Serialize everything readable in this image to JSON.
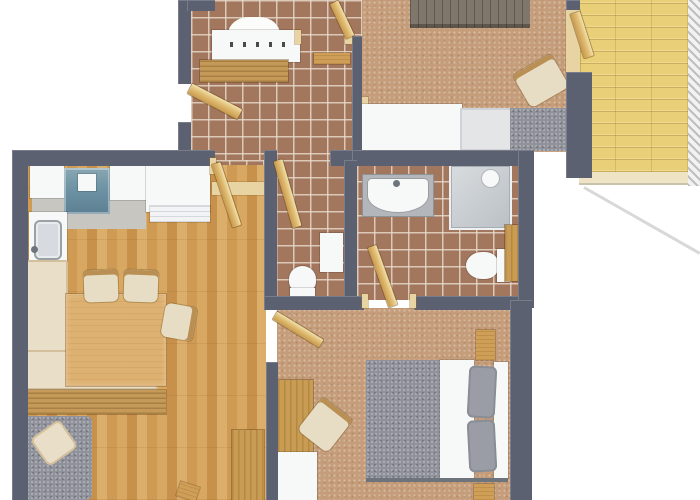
{
  "meta": {
    "kind": "apartment-floor-plan-3d-top-view",
    "canvas": {
      "width": 700,
      "height": 500,
      "background": "#ffffff"
    }
  },
  "palette": {
    "wall": "#5b6170",
    "tile": "#a3765e",
    "carpet": "#c59d7a",
    "wood_floor": "#d2a05b",
    "balcony_wood": "#e9cf78",
    "furniture_wood": "#cf9f58",
    "door_wood": "#e2bf76",
    "white": "#f7f8f8",
    "gray_fabric": "#8f929a",
    "cream": "#e9dfc8",
    "teal": "#6d93a4",
    "steel": "#d7dbdf",
    "dark_dresser": "#7f776b"
  },
  "rooms": [
    {
      "name": "entrance-hall",
      "floor": "tile"
    },
    {
      "name": "bedroom-top",
      "floor": "carpet"
    },
    {
      "name": "balcony",
      "floor": "wood-deck"
    },
    {
      "name": "kitchen-living-dining",
      "floor": "wood"
    },
    {
      "name": "wc",
      "floor": "tile"
    },
    {
      "name": "bathroom",
      "floor": "tile"
    },
    {
      "name": "bedroom-master",
      "floor": "carpet"
    }
  ],
  "items": [
    {
      "n": "hall-tile-floor",
      "c": "tile",
      "x": 191,
      "y": 0,
      "w": 171,
      "h": 166
    },
    {
      "n": "corridor-tile-floor",
      "c": "tile",
      "x": 212,
      "y": 160,
      "w": 52,
      "h": 36
    },
    {
      "n": "wc-tile-floor",
      "c": "tile",
      "x": 276,
      "y": 160,
      "w": 68,
      "h": 140
    },
    {
      "n": "bathroom-tile-floor",
      "c": "tile",
      "x": 357,
      "y": 164,
      "w": 161,
      "h": 136
    },
    {
      "n": "bedroom2-carpet",
      "c": "carpet",
      "x": 362,
      "y": 0,
      "w": 204,
      "h": 152
    },
    {
      "n": "bedroom1-carpet",
      "c": "carpet",
      "x": 277,
      "y": 308,
      "w": 235,
      "h": 192
    },
    {
      "n": "living-wood-floor",
      "c": "woodfloor",
      "x": 27,
      "y": 165,
      "w": 239,
      "h": 335
    },
    {
      "n": "balcony-deck",
      "c": "balcony",
      "x": 579,
      "y": 0,
      "w": 111,
      "h": 172
    },
    {
      "n": "balcony-edge",
      "c": "balc-edge",
      "x": 579,
      "y": 172,
      "w": 109,
      "h": 13
    },
    {
      "n": "balcony-railing",
      "c": "hatch",
      "x": 688,
      "y": 0,
      "w": 12,
      "h": 186
    },
    {
      "n": "balcony-shadow-edge",
      "c": "shadowline",
      "x1": 584,
      "y1": 187,
      "x2": 700,
      "y2": 253,
      "t": 3
    },
    {
      "n": "kitchen-floor",
      "c": "grayfloor",
      "x": 32,
      "y": 196,
      "w": 114,
      "h": 33
    },
    {
      "n": "floor-transition",
      "c": "wood-light",
      "x": 212,
      "y": 182,
      "w": 52,
      "h": 13
    },
    {
      "n": "balcony-threshold",
      "c": "wood-light",
      "x": 566,
      "y": 10,
      "w": 14,
      "h": 62
    },
    {
      "n": "decor-arch",
      "c": "arch",
      "x": 228,
      "y": 17,
      "w": 52,
      "h": 22
    },
    {
      "n": "coat-rack-panel",
      "c": "white",
      "x": 212,
      "y": 30,
      "w": 88,
      "h": 32
    },
    {
      "n": "coat-hooks",
      "c": "hooks",
      "x": 230,
      "y": 42,
      "w": 60,
      "h": 5
    },
    {
      "n": "hall-bench",
      "c": "wood-striped",
      "x": 200,
      "y": 60,
      "w": 88,
      "h": 22
    },
    {
      "n": "hall-wall-shelf",
      "c": "wood",
      "x": 314,
      "y": 53,
      "w": 36,
      "h": 11
    },
    {
      "n": "bedroom2-door-sill",
      "c": "wood-light",
      "x": 352,
      "y": 97,
      "w": 16,
      "h": 13
    },
    {
      "n": "kitchen-counter-left",
      "c": "white",
      "x": 30,
      "y": 166,
      "w": 34,
      "h": 32
    },
    {
      "n": "cooktop",
      "c": "teal",
      "x": 64,
      "y": 168,
      "w": 46,
      "h": 46
    },
    {
      "n": "cooktop-pot",
      "c": "white",
      "x": 78,
      "y": 174,
      "w": 18,
      "h": 17
    },
    {
      "n": "kitchen-counter-mid",
      "c": "white",
      "x": 110,
      "y": 166,
      "w": 36,
      "h": 34
    },
    {
      "n": "kitchen-counter-right",
      "c": "white",
      "x": 146,
      "y": 166,
      "w": 64,
      "h": 46
    },
    {
      "n": "kitchen-cabinet-front",
      "c": "shelf-lines",
      "x": 150,
      "y": 206,
      "w": 60,
      "h": 16
    },
    {
      "n": "sink-counter",
      "c": "white",
      "x": 29,
      "y": 212,
      "w": 38,
      "h": 74
    },
    {
      "n": "kitchen-sink",
      "c": "steel",
      "x": 34,
      "y": 220,
      "w": 28,
      "h": 40
    },
    {
      "n": "sink-faucet",
      "c": "metal",
      "x": 31,
      "y": 246,
      "w": 7,
      "h": 7,
      "rad": "50%"
    },
    {
      "n": "sink-drainboard",
      "c": "ridges",
      "x": 34,
      "y": 262,
      "w": 28,
      "h": 21
    },
    {
      "n": "corner-bench-left",
      "c": "cream",
      "x": 24,
      "y": 260,
      "w": 44,
      "h": 130
    },
    {
      "n": "corner-bench-bottom",
      "c": "cream",
      "x": 24,
      "y": 350,
      "w": 134,
      "h": 40
    },
    {
      "n": "bench-wood-frame",
      "c": "wood-striped",
      "x": 28,
      "y": 390,
      "w": 138,
      "h": 24
    },
    {
      "n": "dining-table",
      "c": "wood-table",
      "x": 66,
      "y": 294,
      "w": 100,
      "h": 92
    },
    {
      "n": "dining-chair-1",
      "c": "chair",
      "x": 84,
      "y": 270,
      "w": 34,
      "h": 32,
      "r": -2
    },
    {
      "n": "dining-chair-2",
      "c": "chair",
      "x": 124,
      "y": 270,
      "w": 34,
      "h": 32,
      "r": 2
    },
    {
      "n": "dining-chair-3",
      "c": "chair",
      "x": 162,
      "y": 306,
      "w": 34,
      "h": 32,
      "r": 100
    },
    {
      "n": "sofa",
      "c": "grayfab",
      "x": 18,
      "y": 416,
      "w": 74,
      "h": 84,
      "rad": "6px"
    },
    {
      "n": "sofa-pillow",
      "c": "cream",
      "x": 36,
      "y": 426,
      "w": 36,
      "h": 34,
      "r": -35,
      "rad": "6px"
    },
    {
      "n": "living-cabinet",
      "c": "woodv",
      "x": 232,
      "y": 430,
      "w": 32,
      "h": 70
    },
    {
      "n": "stool",
      "c": "wood",
      "x": 178,
      "y": 484,
      "w": 20,
      "h": 15,
      "r": 18
    },
    {
      "n": "wc-toilet-bowl",
      "c": "white",
      "x": 289,
      "y": 266,
      "w": 27,
      "h": 26,
      "rad": "50% 50% 40% 40%"
    },
    {
      "n": "wc-toilet-tank",
      "c": "white",
      "x": 290,
      "y": 288,
      "w": 25,
      "h": 9
    },
    {
      "n": "wc-wall-cabinet",
      "c": "white",
      "x": 320,
      "y": 233,
      "w": 23,
      "h": 39
    },
    {
      "n": "vanity-counter",
      "c": "graycounter",
      "x": 363,
      "y": 175,
      "w": 70,
      "h": 41
    },
    {
      "n": "bathroom-sink",
      "c": "white",
      "x": 368,
      "y": 179,
      "w": 60,
      "h": 33,
      "rad": "4px 4px 50% 50%"
    },
    {
      "n": "sink-tap",
      "c": "metal",
      "x": 393,
      "y": 180,
      "w": 7,
      "h": 7,
      "rad": "50%"
    },
    {
      "n": "shower",
      "c": "shower",
      "x": 449,
      "y": 164,
      "w": 63,
      "h": 66
    },
    {
      "n": "shower-head",
      "c": "white",
      "x": 482,
      "y": 170,
      "w": 17,
      "h": 17,
      "rad": "50%"
    },
    {
      "n": "bath-toilet-bowl",
      "c": "white",
      "x": 466,
      "y": 252,
      "w": 32,
      "h": 27,
      "rad": "50% 40% 40% 50%"
    },
    {
      "n": "bath-toilet-tank",
      "c": "white",
      "x": 497,
      "y": 249,
      "w": 13,
      "h": 33
    },
    {
      "n": "bath-shelf",
      "c": "woodv",
      "x": 505,
      "y": 225,
      "w": 16,
      "h": 56
    },
    {
      "n": "bedroom2-dresser",
      "c": "dark-dresser",
      "x": 410,
      "y": 0,
      "w": 120,
      "h": 28
    },
    {
      "n": "bedroom2-chair",
      "c": "chair",
      "x": 519,
      "y": 62,
      "w": 44,
      "h": 38,
      "r": -30
    },
    {
      "n": "bedroom2-bed-duvet",
      "c": "white",
      "x": 362,
      "y": 104,
      "w": 100,
      "h": 47
    },
    {
      "n": "bedroom2-bed-pillow",
      "c": "pillow-light",
      "x": 460,
      "y": 108,
      "w": 52,
      "h": 43
    },
    {
      "n": "bedroom2-bed-blanket",
      "c": "grayfab",
      "x": 510,
      "y": 108,
      "w": 62,
      "h": 43
    },
    {
      "n": "bed-duvet",
      "c": "grayfab",
      "x": 366,
      "y": 360,
      "w": 74,
      "h": 120
    },
    {
      "n": "bed-sheet",
      "c": "white",
      "x": 440,
      "y": 360,
      "w": 34,
      "h": 120
    },
    {
      "n": "bed-headboard",
      "c": "white",
      "x": 494,
      "y": 362,
      "w": 14,
      "h": 116
    },
    {
      "n": "bed-pillow-top",
      "c": "pillow-gray",
      "x": 468,
      "y": 366,
      "w": 28,
      "h": 52,
      "r": 3,
      "rad": "6px"
    },
    {
      "n": "bed-pillow-bottom",
      "c": "pillow-gray",
      "x": 468,
      "y": 420,
      "w": 28,
      "h": 52,
      "r": -3,
      "rad": "6px"
    },
    {
      "n": "bed-footboard",
      "c": "metal",
      "x": 366,
      "y": 478,
      "w": 142,
      "h": 4
    },
    {
      "n": "nightstand",
      "c": "wood",
      "x": 476,
      "y": 330,
      "w": 19,
      "h": 30
    },
    {
      "n": "bedroom1-wardrobe",
      "c": "woodv",
      "x": 278,
      "y": 380,
      "w": 35,
      "h": 74
    },
    {
      "n": "bedroom1-chair",
      "c": "chair",
      "x": 306,
      "y": 404,
      "w": 38,
      "h": 42,
      "r": 38
    },
    {
      "n": "bedroom1-desk",
      "c": "white",
      "x": 267,
      "y": 452,
      "w": 50,
      "h": 48
    },
    {
      "n": "bedroom1-side-table",
      "c": "wood",
      "x": 474,
      "y": 484,
      "w": 20,
      "h": 16
    },
    {
      "n": "wall-hall-left-upper",
      "c": "wall",
      "x": 178,
      "y": 0,
      "w": 13,
      "h": 84
    },
    {
      "n": "wall-hall-left-lower",
      "c": "wall",
      "x": 178,
      "y": 122,
      "w": 13,
      "h": 36
    },
    {
      "n": "wall-top-stub",
      "c": "wall",
      "x": 187,
      "y": 0,
      "w": 28,
      "h": 11
    },
    {
      "n": "wall-kitchen-top",
      "c": "wall",
      "x": 12,
      "y": 150,
      "w": 203,
      "h": 16
    },
    {
      "n": "wall-left-outer",
      "c": "wall",
      "x": 12,
      "y": 150,
      "w": 16,
      "h": 350
    },
    {
      "n": "wall-wc-pier",
      "c": "wall",
      "x": 330,
      "y": 150,
      "w": 36,
      "h": 16
    },
    {
      "n": "wall-hall-bedroom2",
      "c": "wall",
      "x": 352,
      "y": 36,
      "w": 10,
      "h": 116
    },
    {
      "n": "wall-bathroom-top",
      "c": "wall",
      "x": 352,
      "y": 150,
      "w": 166,
      "h": 16
    },
    {
      "n": "wall-bathroom-right",
      "c": "wall",
      "x": 518,
      "y": 150,
      "w": 16,
      "h": 158
    },
    {
      "n": "wall-wc-left",
      "c": "wall",
      "x": 264,
      "y": 150,
      "w": 13,
      "h": 160
    },
    {
      "n": "wall-wc-bath-divider",
      "c": "wall",
      "x": 344,
      "y": 160,
      "w": 13,
      "h": 150
    },
    {
      "n": "wall-bath-bottom-left",
      "c": "wall",
      "x": 264,
      "y": 296,
      "w": 100,
      "h": 14
    },
    {
      "n": "wall-bath-bottom-right",
      "c": "wall",
      "x": 414,
      "y": 296,
      "w": 104,
      "h": 14
    },
    {
      "n": "wall-bedroom1-left",
      "c": "wall",
      "x": 266,
      "y": 362,
      "w": 12,
      "h": 138
    },
    {
      "n": "wall-bedroom1-right",
      "c": "wall",
      "x": 510,
      "y": 300,
      "w": 22,
      "h": 200
    },
    {
      "n": "wall-balcony-stub",
      "c": "wall",
      "x": 566,
      "y": 0,
      "w": 14,
      "h": 10
    },
    {
      "n": "wall-balcony-corner",
      "c": "wall",
      "x": 566,
      "y": 72,
      "w": 26,
      "h": 106
    },
    {
      "n": "door-frame-living",
      "c": "wood-light",
      "x": 210,
      "y": 158,
      "w": 6,
      "h": 16
    },
    {
      "n": "door-frame-bedroom2-a",
      "c": "wood-light",
      "x": 295,
      "y": 30,
      "w": 6,
      "h": 14
    },
    {
      "n": "door-frame-bedroom2-b",
      "c": "wood-light",
      "x": 345,
      "y": 30,
      "w": 7,
      "h": 14
    },
    {
      "n": "door-frame-bath-a",
      "c": "wood-light",
      "x": 362,
      "y": 294,
      "w": 6,
      "h": 14
    },
    {
      "n": "door-frame-bath-b",
      "c": "wood-light",
      "x": 410,
      "y": 294,
      "w": 6,
      "h": 14
    },
    {
      "n": "entrance-door-leaf",
      "c": "door",
      "x1": 190,
      "y1": 88,
      "x2": 240,
      "y2": 114,
      "t": 11
    },
    {
      "n": "living-room-door-leaf",
      "c": "door",
      "x1": 216,
      "y1": 163,
      "x2": 237,
      "y2": 226,
      "t": 9
    },
    {
      "n": "wc-door-leaf",
      "c": "door",
      "x1": 278,
      "y1": 160,
      "x2": 297,
      "y2": 226,
      "t": 9
    },
    {
      "n": "bedroom2-door-leaf",
      "c": "door",
      "x1": 334,
      "y1": 2,
      "x2": 350,
      "y2": 36,
      "t": 9
    },
    {
      "n": "balcony-door-leaf",
      "c": "door",
      "x1": 575,
      "y1": 13,
      "x2": 589,
      "y2": 57,
      "t": 10
    },
    {
      "n": "bathroom-door-leaf",
      "c": "door",
      "x1": 372,
      "y1": 246,
      "x2": 393,
      "y2": 305,
      "t": 9
    },
    {
      "n": "bedroom1-door-leaf",
      "c": "door",
      "x1": 275,
      "y1": 315,
      "x2": 321,
      "y2": 343,
      "t": 9
    }
  ]
}
